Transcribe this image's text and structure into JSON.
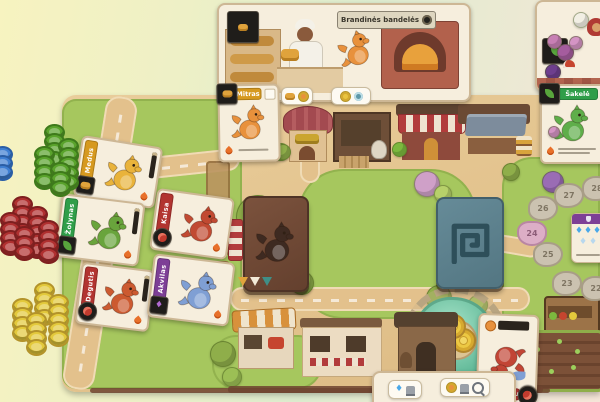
{
  "cards": {
    "bakery": {
      "title": "Brandinės bandelės"
    },
    "mitras": {
      "name": "Mitras"
    },
    "sakele": {
      "name": "Šakelė"
    },
    "medus": {
      "name": "Medus"
    },
    "zolynas": {
      "name": "Žolynas"
    },
    "kaisa": {
      "name": "Kaisa"
    },
    "degutis": {
      "name": "Degutis"
    },
    "akvilas": {
      "name": "Akvilas"
    },
    "smauglis": {
      "name": "Smauglis"
    }
  },
  "score_track": {
    "spaces": [
      {
        "label": "28",
        "x": 595,
        "y": 186,
        "shape": "stone"
      },
      {
        "label": "27",
        "x": 567,
        "y": 193,
        "shape": "stone"
      },
      {
        "label": "26",
        "x": 541,
        "y": 206,
        "shape": "stone"
      },
      {
        "label": "24",
        "x": 530,
        "y": 231,
        "shape": "heart"
      },
      {
        "label": "25",
        "x": 546,
        "y": 252,
        "shape": "stone"
      },
      {
        "label": "23",
        "x": 565,
        "y": 281,
        "shape": "stone"
      },
      {
        "label": "22",
        "x": 594,
        "y": 286,
        "shape": "stone"
      }
    ]
  },
  "fountain": {
    "coins": 3
  },
  "tokens": {
    "groups": [
      {
        "name": "leaf-token",
        "color": "#5aa32c",
        "rim": "#3e7a1b",
        "stacks": [
          [
            44,
            124,
            4
          ],
          [
            34,
            146,
            4
          ],
          [
            58,
            138,
            5
          ],
          [
            50,
            162,
            3
          ]
        ]
      },
      {
        "name": "gem-token",
        "color": "#3f7fd2",
        "rim": "#2a5ea6",
        "stacks": [
          [
            -8,
            146,
            3
          ]
        ]
      },
      {
        "name": "meat-token",
        "color": "#b03030",
        "rim": "#7e1f1f",
        "stacks": [
          [
            12,
            196,
            4
          ],
          [
            0,
            212,
            4
          ],
          [
            27,
            206,
            5
          ],
          [
            14,
            226,
            3
          ],
          [
            38,
            220,
            4
          ]
        ]
      },
      {
        "name": "coin-token",
        "color": "#e3c93c",
        "rim": "#b3932a",
        "stacks": [
          [
            34,
            282,
            4
          ],
          [
            12,
            298,
            4
          ],
          [
            48,
            294,
            5
          ],
          [
            26,
            312,
            4
          ]
        ]
      }
    ]
  },
  "colors": {
    "board": "#e2c28c",
    "park": "#a6c75e",
    "pond": "#5fb897",
    "deck_brown": "#6b4532",
    "deck_teal": "#5b7d8a",
    "banner_gold": "#d6991f",
    "banner_green": "#2f9e49",
    "banner_red": "#b23430",
    "banner_purple": "#7d3f96",
    "coin_gold": "#ecc843"
  }
}
